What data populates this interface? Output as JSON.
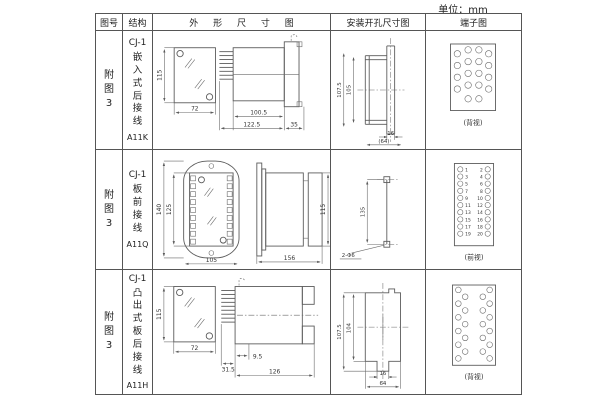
{
  "meta": {
    "unit_label": "单位：mm"
  },
  "header": {
    "fig_no": "图号",
    "structure": "结构",
    "outline": "外 形 尺 寸 图",
    "mounting": "安装开孔尺寸图",
    "terminal": "端子图"
  },
  "rows": [
    {
      "fig_no": "附图3",
      "structure": {
        "model": "CJ-1",
        "desc": "嵌入式后接线",
        "code": "A11K"
      },
      "outline": {
        "front_height": "115",
        "front_width": "72",
        "body_len": "100.5",
        "total_len": "122.5",
        "flange_len": "35"
      },
      "mounting": {
        "dim_outer": "107.5",
        "dim_inner": "105",
        "dim_w1": "16",
        "dim_w2": "(64)"
      },
      "terminal": {
        "caption": "(背视)"
      }
    },
    {
      "fig_no": "附图3",
      "structure": {
        "model": "CJ-1",
        "desc": "板前接线",
        "code": "A11Q"
      },
      "outline": {
        "front_h_outer": "140",
        "front_h_inner": "125",
        "front_width": "105",
        "side_len": "156",
        "side_height": "115"
      },
      "mounting": {
        "dim_v": "135",
        "hole_label": "2-Φ6"
      },
      "terminal": {
        "caption": "(前视)",
        "left_numbers": [
          "1",
          "3",
          "5",
          "7",
          "9",
          "11",
          "13",
          "15",
          "17",
          "19"
        ],
        "right_numbers": [
          "2",
          "4",
          "6",
          "8",
          "10",
          "12",
          "14",
          "16",
          "18",
          "20"
        ]
      }
    },
    {
      "fig_no": "附图3",
      "structure": {
        "model": "CJ-1",
        "desc": "凸出式板后接线",
        "code": "A11H"
      },
      "outline": {
        "front_height": "115",
        "front_width": "72",
        "pin_len": "31.5",
        "gap_len": "9.5",
        "body_len": "126"
      },
      "mounting": {
        "dim_outer": "107.5",
        "dim_inner": "104",
        "dim_w1": "16",
        "dim_w2": "64"
      },
      "terminal": {
        "caption": "(背视)"
      }
    }
  ]
}
